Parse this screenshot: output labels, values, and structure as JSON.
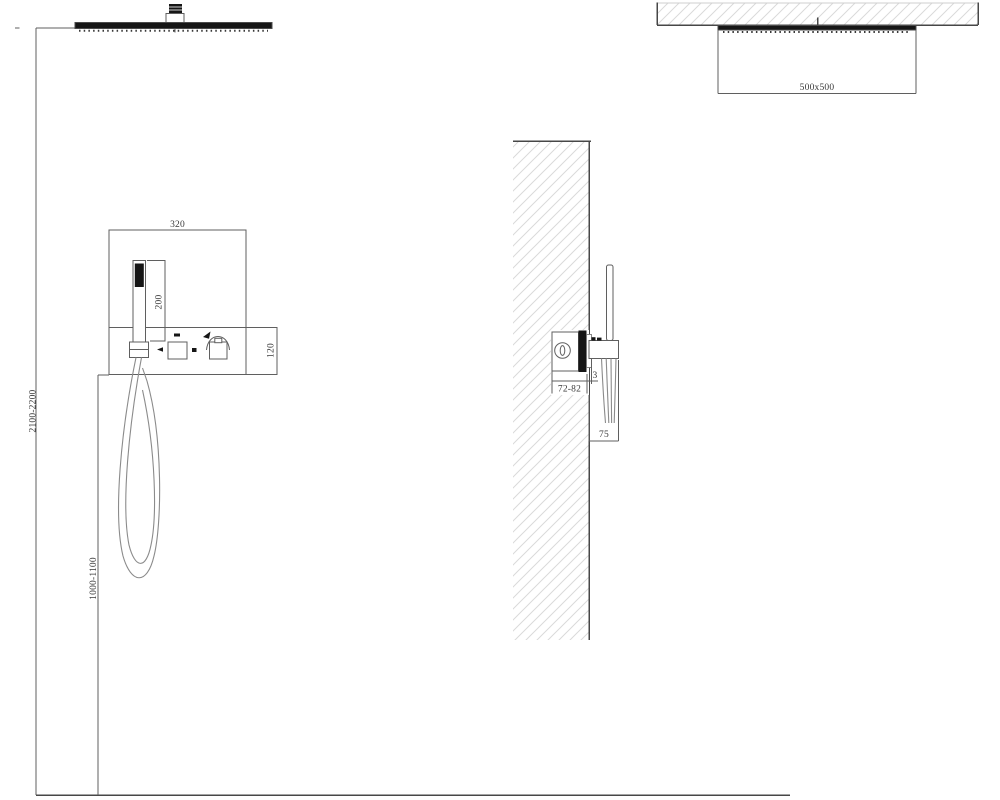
{
  "drawing": {
    "title": "shower-system-installation-drawing",
    "colors": {
      "background": "#ffffff",
      "line": "#5f5f5f",
      "dark_fill": "#161616",
      "hatch": "#dadada",
      "text": "#3a3a3a"
    },
    "front_view": {
      "panel_width_mm": "320",
      "hand_shower_length_mm": "200",
      "trim_height_mm": "120",
      "head_height_range_mm": "2100-2200",
      "panel_height_range_mm": "1000-1100"
    },
    "side_view": {
      "valve_depth_range_mm": "72-82",
      "trim_gap_mm": "3",
      "holder_depth_mm": "75"
    },
    "ceiling_view": {
      "head_dimensions_mm": "500x500"
    }
  }
}
